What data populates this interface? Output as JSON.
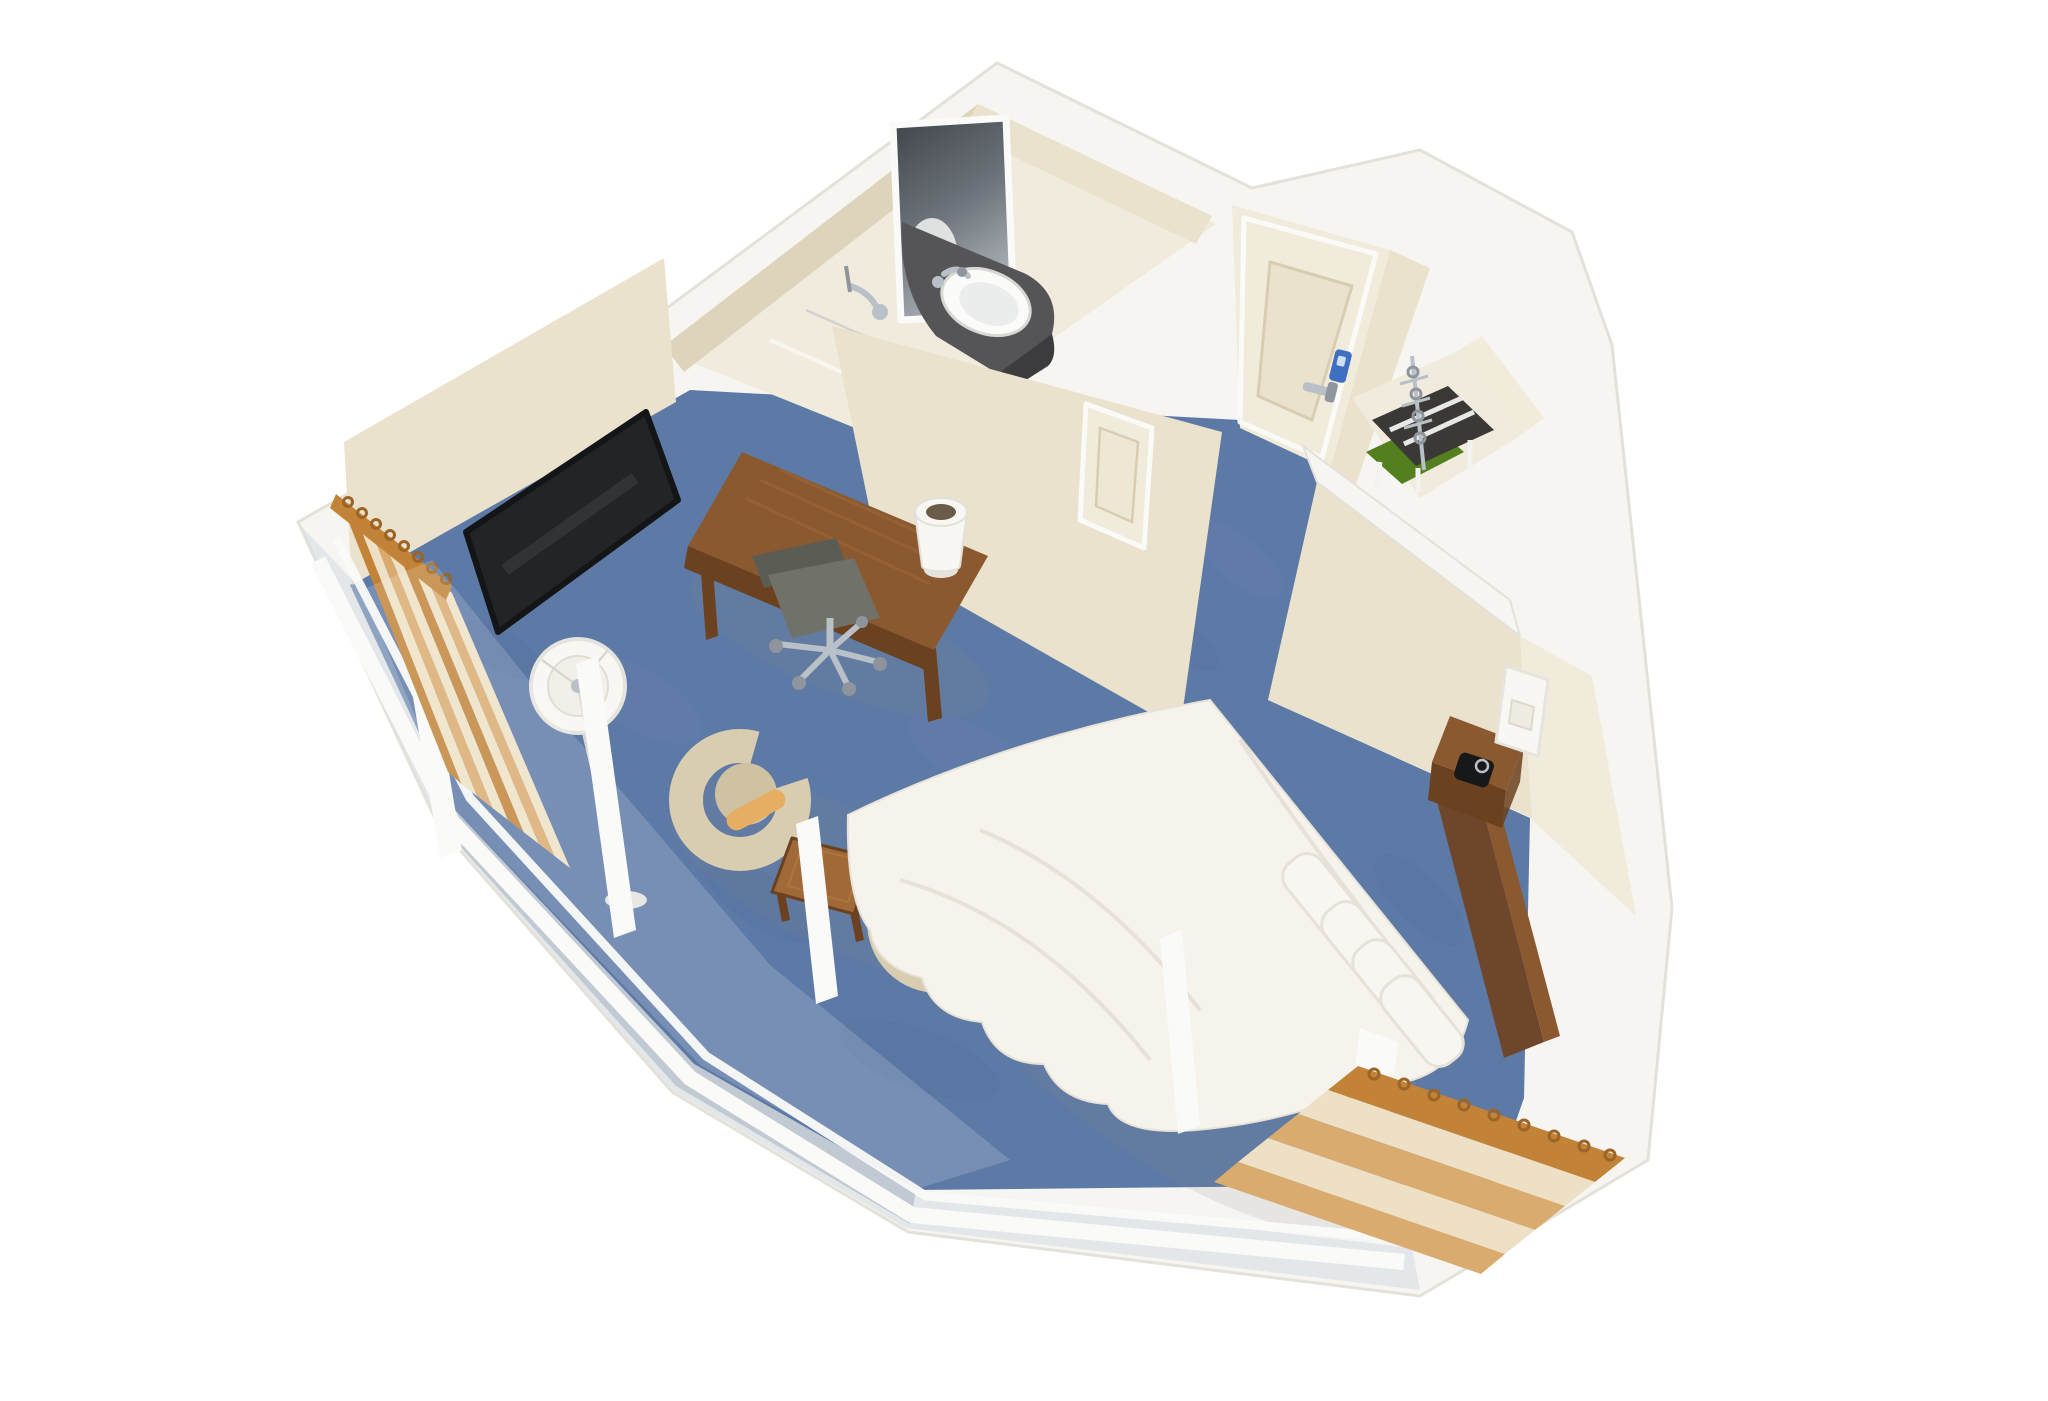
{
  "scene": {
    "type": "3d-room-cutaway-rendering",
    "description": "Bird's-eye cutaway rendering of a hotel guest room: bathroom with vanity sink and lit mirror, entry door with keycard lock, open closet with hangers and luggage rack, queen bed with headboard and nightstand, wall TV, work desk with task chair and lamp, two lounge tub chairs with side table, floor lamp, blue carpet, cream walls and floor-to-ceiling windows with striped pleated curtains",
    "background": "#ffffff"
  },
  "palette": {
    "white_band": "#f6f5f1",
    "edge_line": "#e3e1da",
    "wall_cream": "#eae2cd",
    "wall_cream_dark": "#ded4bb",
    "wall_cream_light": "#f1ebdb",
    "bath_floor": "#f0ebdd",
    "carpet": "#5d7aa6",
    "carpet_light": "#7189b1",
    "carpet_dark": "#4e6a95",
    "glass": "#ccd7df",
    "sill_gray": "#8e9cae",
    "frame_white": "#fafaf8",
    "wood": "#8a5930",
    "wood_dark": "#6b4120",
    "wood_light": "#a06a38",
    "headboard_wood": "#6e462c",
    "tv_black": "#222426",
    "tv_glint": "#3e4144",
    "vanity_dark": "#3c3c3e",
    "vanity_top": "#555557",
    "sink_white": "#fbfbfa",
    "chrome": "#b9c0c7",
    "chrome_dark": "#8e959c",
    "mirror_dark": "#565b60",
    "mirror_light": "#c3c8cd",
    "bedding": "#f5f3ec",
    "bedding_shadow": "#dcd7c9",
    "pillow": "#f8f6f0",
    "chair_beige": "#d8cdb0",
    "chair_seat": "#cfc2a2",
    "bolster": "#e6ae62",
    "office_gray": "#70726a",
    "office_gray_dark": "#5b5d55",
    "curtain_orange": "#c28339",
    "curtain_tan": "#d9ab6e",
    "curtain_cream": "#eee0c4",
    "curtain_hook": "#9c6426",
    "lock_blue": "#3f6fc1",
    "board_green": "#547f1f",
    "lamp_white": "#f8f7f3",
    "lamp_rim": "#e5e3dd",
    "shadow": "#8a8a85"
  },
  "objects": {
    "room": "hotel guest room cutaway",
    "bathroom": "bathroom with vanity, sink, mirror and shower",
    "vanity": "dark granite vanity counter",
    "sink": "white oval sink with chrome faucet",
    "mirror": "lighted wall mirror",
    "shower": "chrome shower fixture",
    "entry_door": "entry door with chrome lever handle",
    "keycard_lock": "blue keycard lock",
    "sliding_door": "bathroom sliding door",
    "closet": "open closet with hanger rail, luggage rack and ironing board",
    "bed": "queen bed with white duvet and four pillows",
    "headboard": "dark wood headboard",
    "nightstand": "wood nightstand with lamp and alarm clock",
    "tv": "wall mounted flat screen TV",
    "desk": "wood work desk with desk lamp",
    "office_chair": "gray task chair with chrome base",
    "floor_lamp": "floor lamp with white drum shade",
    "tub_chairs": "two beige tub chairs with tan bolster pillows",
    "side_table": "square wood side table",
    "windows": "floor to ceiling window wall with white mullions",
    "curtains": "striped pleated curtains in orange, tan and cream",
    "carpet": "blue mottled carpet"
  }
}
